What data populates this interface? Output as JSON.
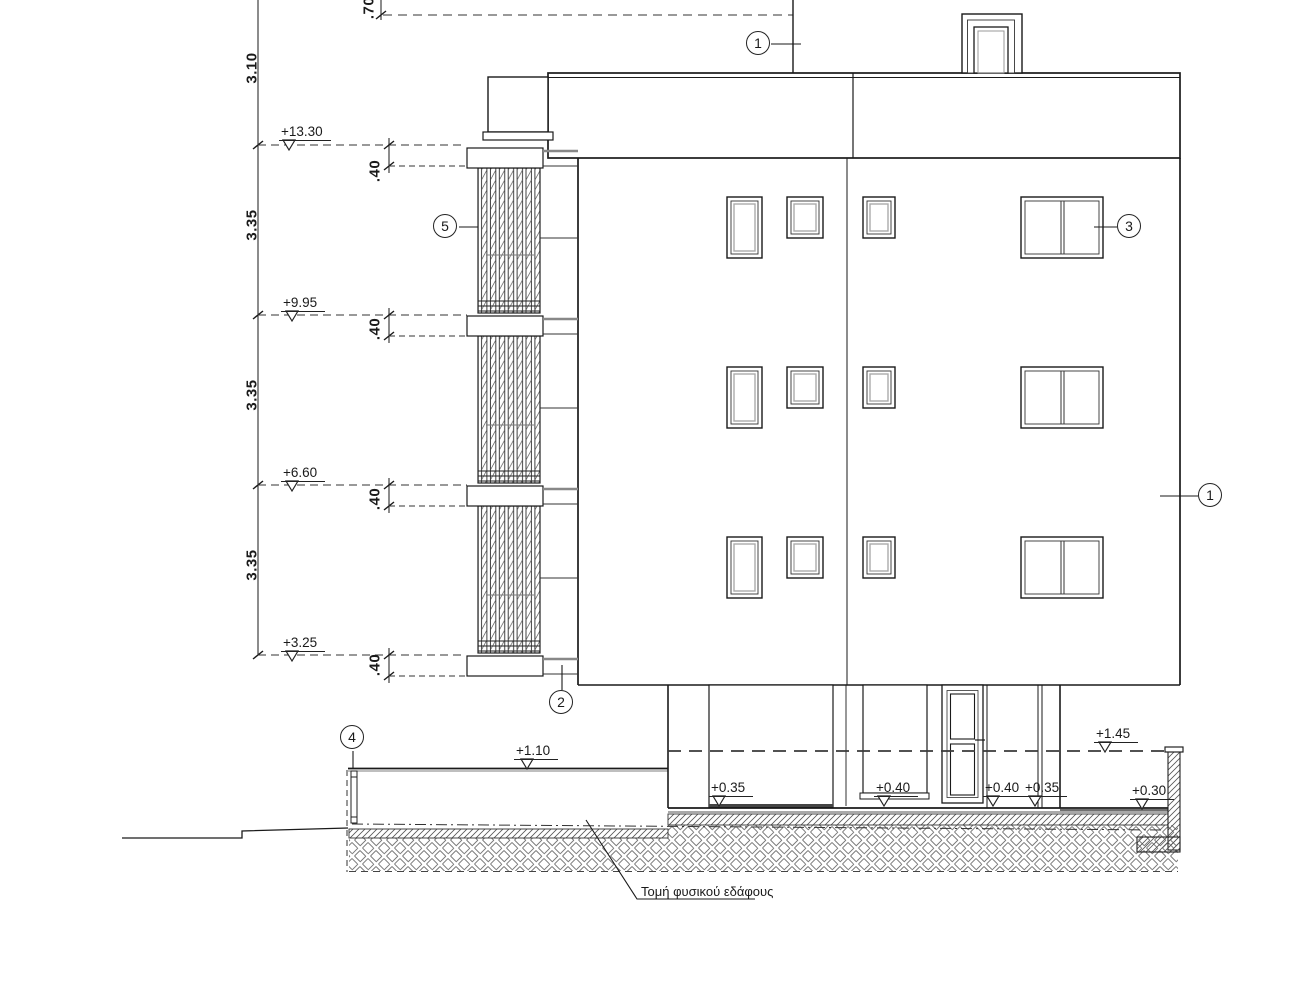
{
  "dimensions": {
    "parapet": ".70",
    "top_floor_height": "3.10",
    "floor_heights": [
      "3.35",
      "3.35",
      "3.35"
    ],
    "slab_thicknesses": [
      ".40",
      ".40",
      ".40",
      ".40"
    ]
  },
  "elevation_levels": {
    "roof_slab": "+13.30",
    "floor3": "+9.95",
    "floor2": "+6.60",
    "floor1": "+3.25",
    "yard_left": "+1.10",
    "boundary_right": "+1.45",
    "ground": [
      "+0.35",
      "+0.40",
      "+0.40",
      "+0.35",
      "+0.30"
    ]
  },
  "callout_markers": {
    "roof_wall": "1",
    "facade_right": "1",
    "balcony_slab": "2",
    "window": "3",
    "fence": "4",
    "louver_screen": "5"
  },
  "notes": {
    "natural_ground_section": "Τομή φυσικού εδάφους"
  },
  "colors": {
    "line": "#1a1a1a",
    "background": "#ffffff"
  }
}
